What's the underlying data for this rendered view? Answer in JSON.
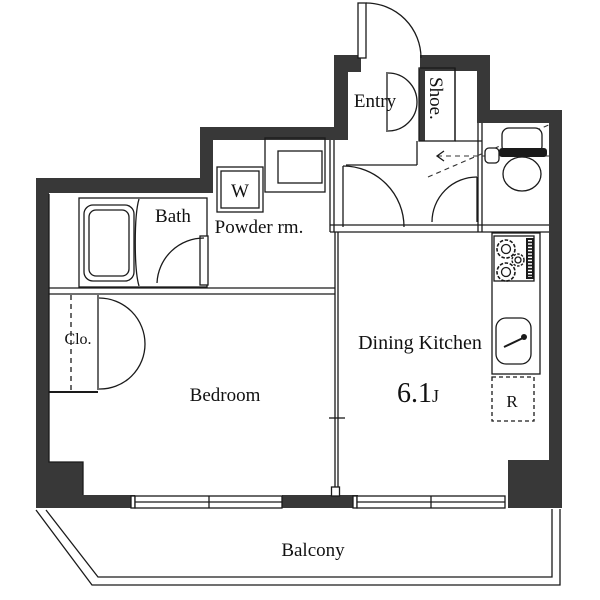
{
  "floorplan": {
    "labels": {
      "entry": "Entry",
      "shoe": "Shoe.",
      "bath": "Bath",
      "powder_room": "Powder rm.",
      "washer": "W",
      "closet": "Clo.",
      "bedroom": "Bedroom",
      "dining_kitchen": "Dining Kitchen",
      "dk_size": "6.1",
      "dk_size_unit": "J",
      "refrigerator": "R",
      "balcony": "Balcony"
    },
    "colors": {
      "wall": "#383838",
      "line": "#1a1a1a",
      "background": "#ffffff"
    },
    "fixtures": [
      "entrance-door",
      "shoe-cabinet",
      "toilet",
      "bathtub",
      "bath-door",
      "washing-machine-pan",
      "vanity-sink",
      "closet-double-door",
      "gas-stove",
      "kitchen-sink",
      "refrigerator-space",
      "sliding-window",
      "balcony-railing"
    ]
  }
}
